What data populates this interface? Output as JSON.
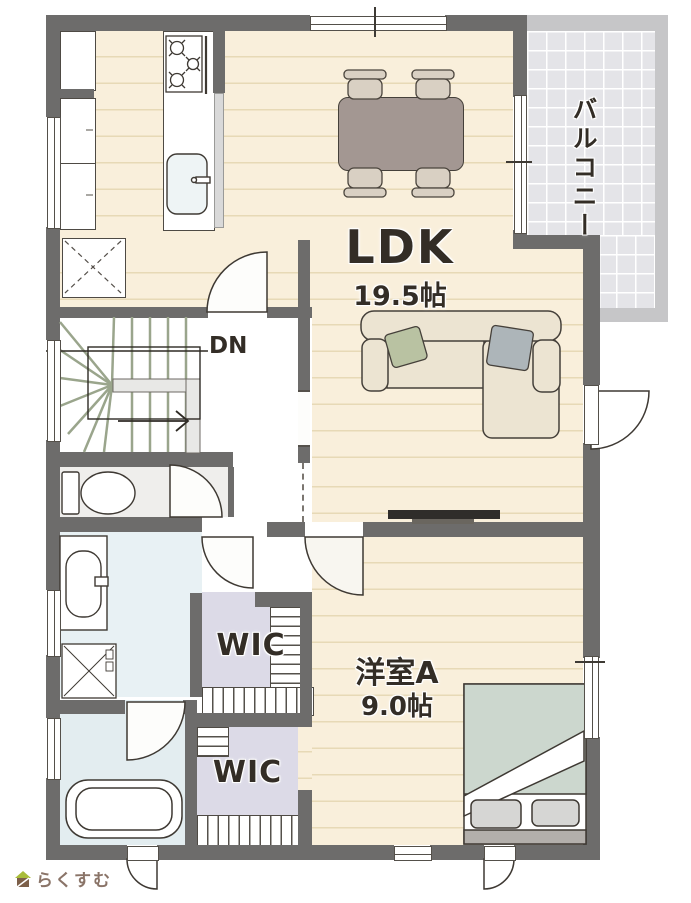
{
  "rooms": {
    "ldk": {
      "label": "LDK",
      "area": "19.5帖"
    },
    "bedroom_a": {
      "label": "洋室A",
      "area": "9.0帖"
    },
    "wic_upper": {
      "label": "WIC"
    },
    "wic_lower": {
      "label": "WIC"
    },
    "balcony": {
      "label": "バルコニー"
    },
    "stairs": {
      "label": "DN"
    }
  },
  "logo": {
    "text": "らくすむ"
  },
  "colors": {
    "wall": "#6d6c6b",
    "balcony_wall": "#c6c6c8",
    "wood_floor": "#f9efdb",
    "wic_floor": "#dcdae7",
    "wet_area_floor": "#e8f1f4",
    "balcony_floor": "#e4e4e8",
    "label_text": "#332d26",
    "logo_text": "#8a7468",
    "sofa": "#ece4d2",
    "cushion_green": "#b9c2a2",
    "cushion_gray": "#adb5b9",
    "dining_table": "#a39792",
    "bed_duvet": "#ccd7ce"
  }
}
